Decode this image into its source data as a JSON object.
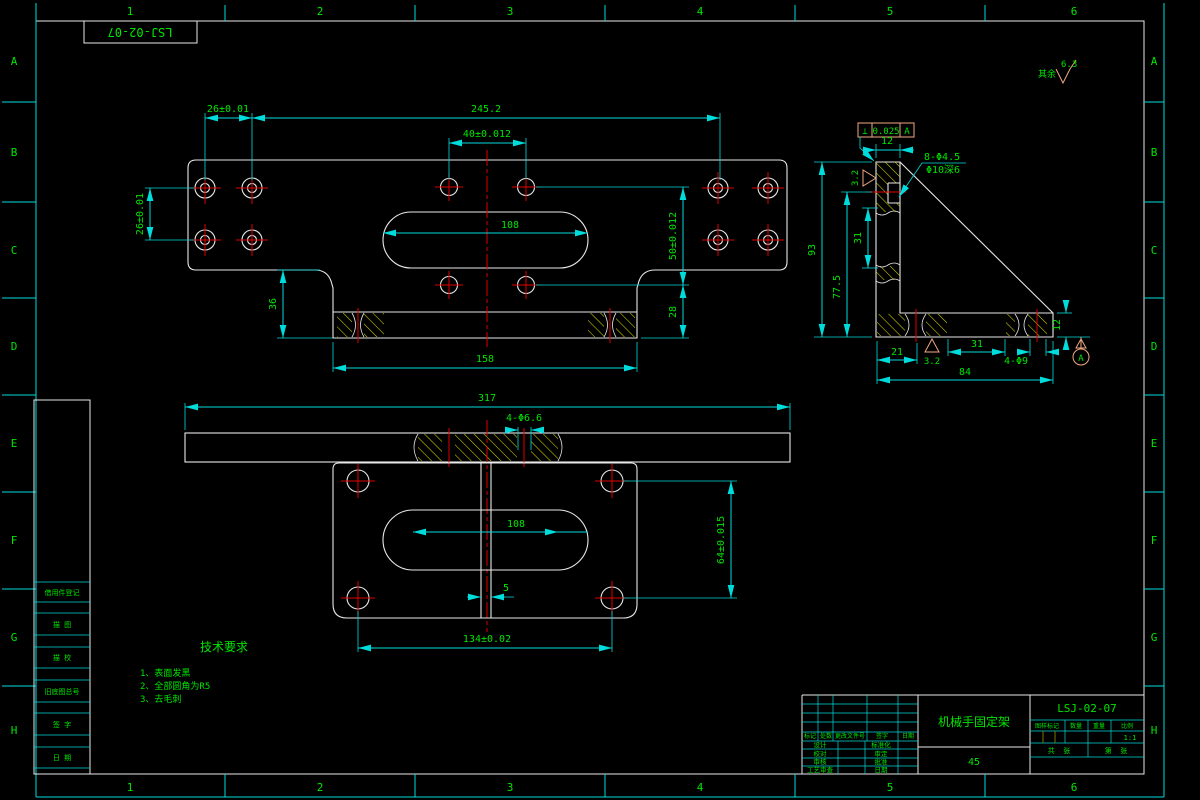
{
  "drawing": {
    "code_mirrored": "LSJ-02-07",
    "surface_note": {
      "prefix": "其余",
      "roughness": "6.3"
    },
    "border": {
      "columns": [
        "1",
        "2",
        "3",
        "4",
        "5",
        "6"
      ],
      "rows": [
        "A",
        "B",
        "C",
        "D",
        "E",
        "F",
        "G",
        "H"
      ]
    },
    "sidebar": {
      "labels": [
        "借用件登记",
        "描 图",
        "描 校",
        "旧底图总号",
        "签 字",
        "日 期"
      ]
    },
    "top_view": {
      "dim_26_top": "26±0.01",
      "dim_245": "245.2",
      "dim_40": "40±0.012",
      "dim_26_left": "26±0.01",
      "dim_108": "108",
      "dim_50": "50±0.012",
      "dim_28": "28",
      "dim_36": "36",
      "dim_158": "158"
    },
    "side_view": {
      "dim_12_top": "12",
      "fcf": {
        "symbol": "⊥",
        "tolerance": "0.025",
        "datum": "A"
      },
      "holes_note": "8-Φ4.5",
      "cbore_note": "Φ10深6",
      "dim_93": "93",
      "dim_77_5": "77.5",
      "dim_31": "31",
      "rough_left": "3.2",
      "rough_bottom": "3.2",
      "dim_21": "21",
      "dim_31_b": "31",
      "holes_note_b": "4-Φ9",
      "dim_84": "84",
      "dim_12_r": "12",
      "datum_label": "A"
    },
    "bottom_view": {
      "dim_317": "317",
      "holes_note": "4-Φ6.6",
      "dim_108": "108",
      "dim_64": "64±0.015",
      "dim_5": "5",
      "dim_134": "134±0.02"
    },
    "tech_req": {
      "title": "技术要求",
      "items": [
        "1、表面发黑",
        "2、全部圆角为R5",
        "3、去毛刺"
      ]
    },
    "title_block": {
      "rev_headers": [
        "标记",
        "处数",
        "更改文件号",
        "签字",
        "日期"
      ],
      "sign_rows": [
        {
          "left": "设计",
          "right": "标准化"
        },
        {
          "left": "校对",
          "right": "审定"
        },
        {
          "left": "审核",
          "right": "批准"
        },
        {
          "left": "工艺审查",
          "right": "日期"
        }
      ],
      "part_name": "机械手固定架",
      "material": "45",
      "drawing_no": "LSJ-02-07",
      "info_headers": [
        "图样标记",
        "数量",
        "重量",
        "比例"
      ],
      "scale": "1:1",
      "sheet_left": "共  张",
      "sheet_right": "第  张"
    }
  }
}
